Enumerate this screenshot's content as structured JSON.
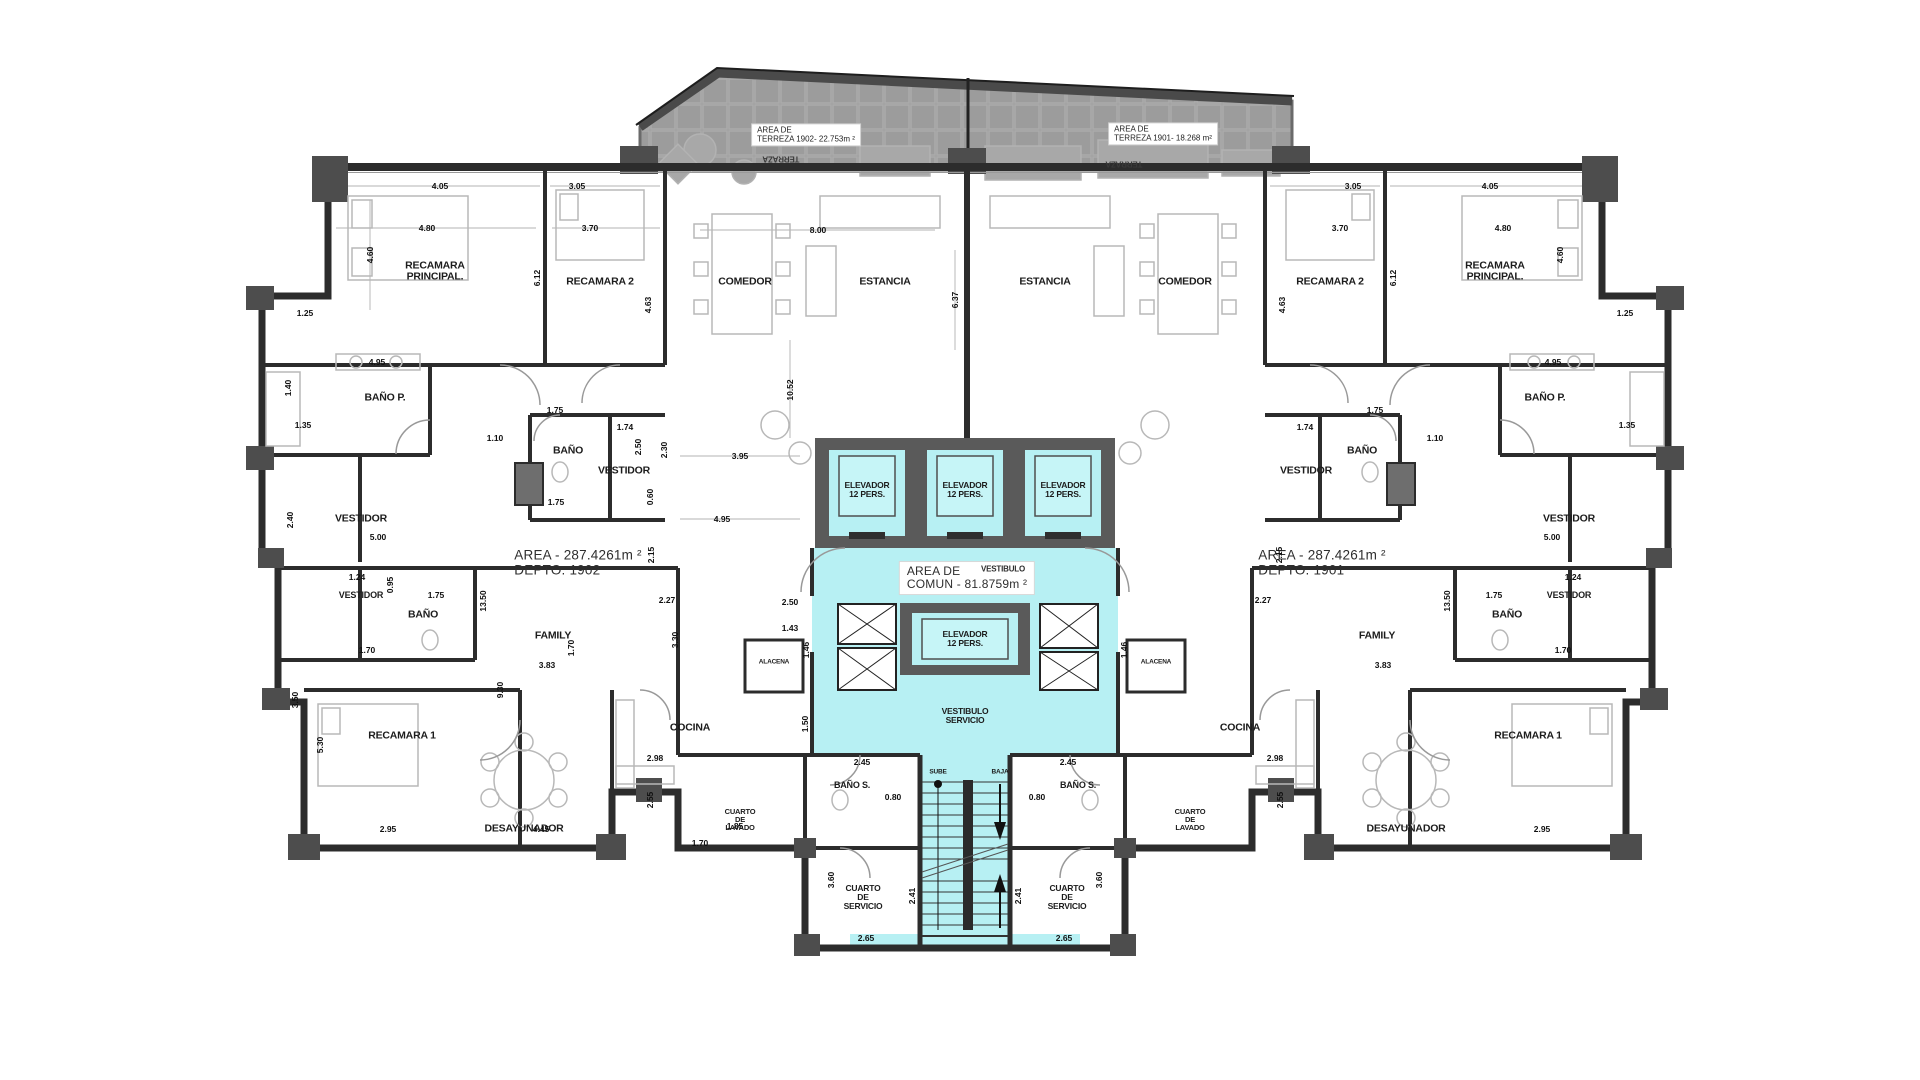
{
  "document": {
    "type": "architectural-floor-plan",
    "level_units": [
      "DEPTO. 1901",
      "DEPTO. 1902"
    ]
  },
  "colors": {
    "common_area_cyan": "#b7f0f3",
    "elevator_cabin_cyan": "#c6f5f7",
    "core_wall_gray": "#5a5a5a",
    "terrace_gray": "#9c9c9c",
    "wall_dark": "#2c2c2c",
    "furniture_gray": "#b8b8b8",
    "paper_white": "#ffffff"
  },
  "labels": [
    {
      "name": "terraza-box-1902",
      "lines": [
        "AREA DE",
        "TERREZA 1902- 22.753m ²"
      ],
      "x": 806,
      "y": 135,
      "cls": "tbox"
    },
    {
      "name": "terraza-box-1901",
      "lines": [
        "AREA DE",
        "TERREZA 1901- 18.268 m²"
      ],
      "x": 1163,
      "y": 134,
      "cls": "tbox"
    },
    {
      "name": "terraza-rotated-1902",
      "lines": [
        "TERRAZA"
      ],
      "x": 781,
      "y": 158,
      "fs": 8,
      "rot": 180,
      "cls": "trot"
    },
    {
      "name": "terraza-rotated-1901",
      "lines": [
        "TERRAZA"
      ],
      "x": 1124,
      "y": 163,
      "fs": 8,
      "rot": 180,
      "cls": "trot"
    },
    {
      "name": "room-recamara-principal-1902",
      "lines": [
        "RECAMARA",
        "PRINCIPAL."
      ],
      "x": 435,
      "y": 272
    },
    {
      "name": "room-recamara-2-1902",
      "lines": [
        "RECAMARA 2"
      ],
      "x": 600,
      "y": 282
    },
    {
      "name": "room-comedor-1902",
      "lines": [
        "COMEDOR"
      ],
      "x": 745,
      "y": 282
    },
    {
      "name": "room-estancia-1902",
      "lines": [
        "ESTANCIA"
      ],
      "x": 885,
      "y": 282
    },
    {
      "name": "room-estancia-1901",
      "lines": [
        "ESTANCIA"
      ],
      "x": 1045,
      "y": 282
    },
    {
      "name": "room-comedor-1901",
      "lines": [
        "COMEDOR"
      ],
      "x": 1185,
      "y": 282
    },
    {
      "name": "room-recamara-2-1901",
      "lines": [
        "RECAMARA 2"
      ],
      "x": 1330,
      "y": 282
    },
    {
      "name": "room-recamara-principal-1901",
      "lines": [
        "RECAMARA",
        "PRINCIPAL."
      ],
      "x": 1495,
      "y": 272
    },
    {
      "name": "room-bano-p-1902",
      "lines": [
        "BAÑO P."
      ],
      "x": 385,
      "y": 398
    },
    {
      "name": "room-bano-p-1901",
      "lines": [
        "BAÑO P."
      ],
      "x": 1545,
      "y": 398
    },
    {
      "name": "room-bano-upper-1902",
      "lines": [
        "BAÑO"
      ],
      "x": 568,
      "y": 451
    },
    {
      "name": "room-bano-upper-1901",
      "lines": [
        "BAÑO"
      ],
      "x": 1362,
      "y": 451
    },
    {
      "name": "room-vestidor-upper-1902",
      "lines": [
        "VESTIDOR"
      ],
      "x": 624,
      "y": 471
    },
    {
      "name": "room-vestidor-upper-1901",
      "lines": [
        "VESTIDOR"
      ],
      "x": 1306,
      "y": 471
    },
    {
      "name": "room-vestidor-wing-1902",
      "lines": [
        "VESTIDOR"
      ],
      "x": 361,
      "y": 519
    },
    {
      "name": "room-vestidor-wing-1901",
      "lines": [
        "VESTIDOR"
      ],
      "x": 1569,
      "y": 519
    },
    {
      "name": "room-vestidor-small-1902",
      "lines": [
        "VESTIDOR"
      ],
      "x": 361,
      "y": 596,
      "fs": 9
    },
    {
      "name": "room-vestidor-small-1901",
      "lines": [
        "VESTIDOR"
      ],
      "x": 1569,
      "y": 596,
      "fs": 9
    },
    {
      "name": "room-bano-lower-1902",
      "lines": [
        "BAÑO"
      ],
      "x": 423,
      "y": 615
    },
    {
      "name": "room-bano-lower-1901",
      "lines": [
        "BAÑO"
      ],
      "x": 1507,
      "y": 615
    },
    {
      "name": "room-family-1902",
      "lines": [
        "FAMILY"
      ],
      "x": 553,
      "y": 636
    },
    {
      "name": "room-family-1901",
      "lines": [
        "FAMILY"
      ],
      "x": 1377,
      "y": 636
    },
    {
      "name": "room-cocina-1902",
      "lines": [
        "COCINA"
      ],
      "x": 690,
      "y": 728
    },
    {
      "name": "room-cocina-1901",
      "lines": [
        "COCINA"
      ],
      "x": 1240,
      "y": 728
    },
    {
      "name": "room-recamara-1-1902",
      "lines": [
        "RECAMARA 1"
      ],
      "x": 402,
      "y": 736
    },
    {
      "name": "room-recamara-1-1901",
      "lines": [
        "RECAMARA 1"
      ],
      "x": 1528,
      "y": 736
    },
    {
      "name": "room-desayunador-1902",
      "lines": [
        "DESAYUNADOR"
      ],
      "x": 524,
      "y": 829
    },
    {
      "name": "room-desayunador-1901",
      "lines": [
        "DESAYUNADOR"
      ],
      "x": 1406,
      "y": 829
    },
    {
      "name": "room-cuarto-lavado-1902",
      "lines": [
        "CUARTO",
        "DE",
        "LAVADO"
      ],
      "x": 740,
      "y": 820,
      "fs": 7.5
    },
    {
      "name": "room-cuarto-lavado-1901",
      "lines": [
        "CUARTO",
        "DE",
        "LAVADO"
      ],
      "x": 1190,
      "y": 820,
      "fs": 7.5
    },
    {
      "name": "room-bano-s-1902",
      "lines": [
        "BAÑO S."
      ],
      "x": 852,
      "y": 786,
      "fs": 9
    },
    {
      "name": "room-bano-s-1901",
      "lines": [
        "BAÑO S."
      ],
      "x": 1078,
      "y": 786,
      "fs": 9
    },
    {
      "name": "room-cuarto-servicio-1902",
      "lines": [
        "CUARTO",
        "DE",
        "SERVICIO"
      ],
      "x": 863,
      "y": 898,
      "fs": 8.5
    },
    {
      "name": "room-cuarto-servicio-1901",
      "lines": [
        "CUARTO",
        "DE",
        "SERVICIO"
      ],
      "x": 1067,
      "y": 898,
      "fs": 8.5
    },
    {
      "name": "room-alacena-1902",
      "lines": [
        "ALACENA"
      ],
      "x": 774,
      "y": 662,
      "fs": 6.5
    },
    {
      "name": "room-alacena-1901",
      "lines": [
        "ALACENA"
      ],
      "x": 1156,
      "y": 662,
      "fs": 6.5
    },
    {
      "name": "elevator-bank-left-label",
      "lines": [
        "ELEVADOR",
        "12 PERS."
      ],
      "x": 867,
      "y": 490,
      "fs": 8.5
    },
    {
      "name": "elevator-bank-mid-label",
      "lines": [
        "ELEVADOR",
        "12 PERS."
      ],
      "x": 965,
      "y": 490,
      "fs": 8.5
    },
    {
      "name": "elevator-bank-right-label",
      "lines": [
        "ELEVADOR",
        "12 PERS."
      ],
      "x": 1063,
      "y": 490,
      "fs": 8.5
    },
    {
      "name": "elevator-central-label",
      "lines": [
        "ELEVADOR",
        "12 PERS."
      ],
      "x": 965,
      "y": 639,
      "fs": 8.5
    },
    {
      "name": "common-area-box",
      "lines": [
        "AREA DE",
        "COMUN - 81.8759m ²"
      ],
      "x": 967,
      "y": 578,
      "fs": 12,
      "cls": "boxed area"
    },
    {
      "name": "vestibulo-label",
      "lines": [
        "VESTIBULO"
      ],
      "x": 1003,
      "y": 570,
      "fs": 8,
      "cls": "ghost"
    },
    {
      "name": "vestibulo-servicio-label",
      "lines": [
        "VESTIBULO",
        "SERVICIO"
      ],
      "x": 965,
      "y": 716,
      "fs": 8.5
    },
    {
      "name": "stairs-sube-label",
      "lines": [
        "SUBE"
      ],
      "x": 938,
      "y": 772,
      "fs": 6.5
    },
    {
      "name": "stairs-baja-label",
      "lines": [
        "BAJA"
      ],
      "x": 1000,
      "y": 772,
      "fs": 6.5
    },
    {
      "name": "unit-area-1902",
      "lines": [
        "AREA - 287.4261m ²",
        "DEPTO. 1902"
      ],
      "x": 578,
      "y": 563,
      "cls": "area"
    },
    {
      "name": "unit-area-1901",
      "lines": [
        "AREA - 287.4261m ²",
        "DEPTO. 1901"
      ],
      "x": 1322,
      "y": 563,
      "cls": "area"
    }
  ],
  "dims": [
    {
      "t": "4.05",
      "x": 440,
      "y": 186
    },
    {
      "t": "3.05",
      "x": 577,
      "y": 186
    },
    {
      "t": "4.80",
      "x": 427,
      "y": 228
    },
    {
      "t": "3.70",
      "x": 590,
      "y": 228
    },
    {
      "t": "8.00",
      "x": 818,
      "y": 230
    },
    {
      "t": "1.25",
      "x": 305,
      "y": 313
    },
    {
      "t": "4.95",
      "x": 377,
      "y": 362
    },
    {
      "t": "1.35",
      "x": 303,
      "y": 425
    },
    {
      "t": "1.10",
      "x": 495,
      "y": 438
    },
    {
      "t": "1.75",
      "x": 555,
      "y": 410
    },
    {
      "t": "1.74",
      "x": 625,
      "y": 427
    },
    {
      "t": "1.75",
      "x": 556,
      "y": 502
    },
    {
      "t": "3.95",
      "x": 740,
      "y": 456
    },
    {
      "t": "4.95",
      "x": 722,
      "y": 519
    },
    {
      "t": "5.00",
      "x": 378,
      "y": 537
    },
    {
      "t": "1.24",
      "x": 357,
      "y": 577
    },
    {
      "t": "1.75",
      "x": 436,
      "y": 595
    },
    {
      "t": "2.27",
      "x": 667,
      "y": 600
    },
    {
      "t": "1.70",
      "x": 367,
      "y": 650
    },
    {
      "t": "3.83",
      "x": 547,
      "y": 665
    },
    {
      "t": "2.50",
      "x": 790,
      "y": 602
    },
    {
      "t": "1.43",
      "x": 790,
      "y": 628
    },
    {
      "t": "2.98",
      "x": 655,
      "y": 758
    },
    {
      "t": "2.95",
      "x": 388,
      "y": 829
    },
    {
      "t": "4.45",
      "x": 541,
      "y": 829
    },
    {
      "t": "1.70",
      "x": 700,
      "y": 843
    },
    {
      "t": "1.85",
      "x": 735,
      "y": 826
    },
    {
      "t": "2.45",
      "x": 862,
      "y": 762
    },
    {
      "t": "0.80",
      "x": 893,
      "y": 797
    },
    {
      "t": "2.65",
      "x": 866,
      "y": 938
    },
    {
      "t": "3.05",
      "x": 1353,
      "y": 186
    },
    {
      "t": "4.05",
      "x": 1490,
      "y": 186
    },
    {
      "t": "3.70",
      "x": 1340,
      "y": 228
    },
    {
      "t": "4.80",
      "x": 1503,
      "y": 228
    },
    {
      "t": "1.25",
      "x": 1625,
      "y": 313
    },
    {
      "t": "4.95",
      "x": 1553,
      "y": 362
    },
    {
      "t": "1.35",
      "x": 1627,
      "y": 425
    },
    {
      "t": "1.10",
      "x": 1435,
      "y": 438
    },
    {
      "t": "1.75",
      "x": 1375,
      "y": 410
    },
    {
      "t": "1.74",
      "x": 1305,
      "y": 427
    },
    {
      "t": "5.00",
      "x": 1552,
      "y": 537
    },
    {
      "t": "3.83",
      "x": 1383,
      "y": 665
    },
    {
      "t": "2.45",
      "x": 1068,
      "y": 762
    },
    {
      "t": "0.80",
      "x": 1037,
      "y": 797
    },
    {
      "t": "2.65",
      "x": 1064,
      "y": 938
    },
    {
      "t": "2.95",
      "x": 1542,
      "y": 829
    },
    {
      "t": "2.98",
      "x": 1275,
      "y": 758
    },
    {
      "t": "1.24",
      "x": 1573,
      "y": 577
    },
    {
      "t": "1.75",
      "x": 1494,
      "y": 595
    },
    {
      "t": "2.27",
      "x": 1263,
      "y": 600
    },
    {
      "t": "1.70",
      "x": 1563,
      "y": 650
    },
    {
      "t": "4.60",
      "x": 370,
      "y": 255,
      "v": 1
    },
    {
      "t": "6.12",
      "x": 537,
      "y": 278,
      "v": 1
    },
    {
      "t": "4.63",
      "x": 648,
      "y": 305,
      "v": 1
    },
    {
      "t": "6.37",
      "x": 955,
      "y": 300,
      "v": 1
    },
    {
      "t": "10.52",
      "x": 790,
      "y": 390,
      "v": 1
    },
    {
      "t": "1.40",
      "x": 288,
      "y": 388,
      "v": 1
    },
    {
      "t": "2.40",
      "x": 290,
      "y": 520,
      "v": 1
    },
    {
      "t": "2.50",
      "x": 638,
      "y": 447,
      "v": 1
    },
    {
      "t": "2.30",
      "x": 664,
      "y": 450,
      "v": 1
    },
    {
      "t": "0.60",
      "x": 650,
      "y": 497,
      "v": 1
    },
    {
      "t": "2.15",
      "x": 651,
      "y": 555,
      "v": 1
    },
    {
      "t": "0.95",
      "x": 390,
      "y": 585,
      "v": 1
    },
    {
      "t": "13.50",
      "x": 483,
      "y": 601,
      "v": 1
    },
    {
      "t": "1.70",
      "x": 571,
      "y": 648,
      "v": 1
    },
    {
      "t": "3.30",
      "x": 675,
      "y": 640,
      "v": 1
    },
    {
      "t": "9.30",
      "x": 500,
      "y": 690,
      "v": 1
    },
    {
      "t": "1.46",
      "x": 806,
      "y": 650,
      "v": 1
    },
    {
      "t": "1.50",
      "x": 805,
      "y": 724,
      "v": 1
    },
    {
      "t": "3.50",
      "x": 295,
      "y": 700,
      "v": 1
    },
    {
      "t": "5.30",
      "x": 320,
      "y": 745,
      "v": 1
    },
    {
      "t": "2.55",
      "x": 650,
      "y": 800,
      "v": 1
    },
    {
      "t": "3.60",
      "x": 831,
      "y": 880,
      "v": 1
    },
    {
      "t": "2.41",
      "x": 912,
      "y": 896,
      "v": 1
    },
    {
      "t": "4.63",
      "x": 1282,
      "y": 305,
      "v": 1
    },
    {
      "t": "6.12",
      "x": 1393,
      "y": 278,
      "v": 1
    },
    {
      "t": "4.60",
      "x": 1560,
      "y": 255,
      "v": 1
    },
    {
      "t": "13.50",
      "x": 1447,
      "y": 601,
      "v": 1
    },
    {
      "t": "3.60",
      "x": 1099,
      "y": 880,
      "v": 1
    },
    {
      "t": "2.41",
      "x": 1018,
      "y": 896,
      "v": 1
    },
    {
      "t": "2.55",
      "x": 1280,
      "y": 800,
      "v": 1
    },
    {
      "t": "1.46",
      "x": 1124,
      "y": 650,
      "v": 1
    },
    {
      "t": "2.15",
      "x": 1279,
      "y": 555,
      "v": 1
    }
  ]
}
